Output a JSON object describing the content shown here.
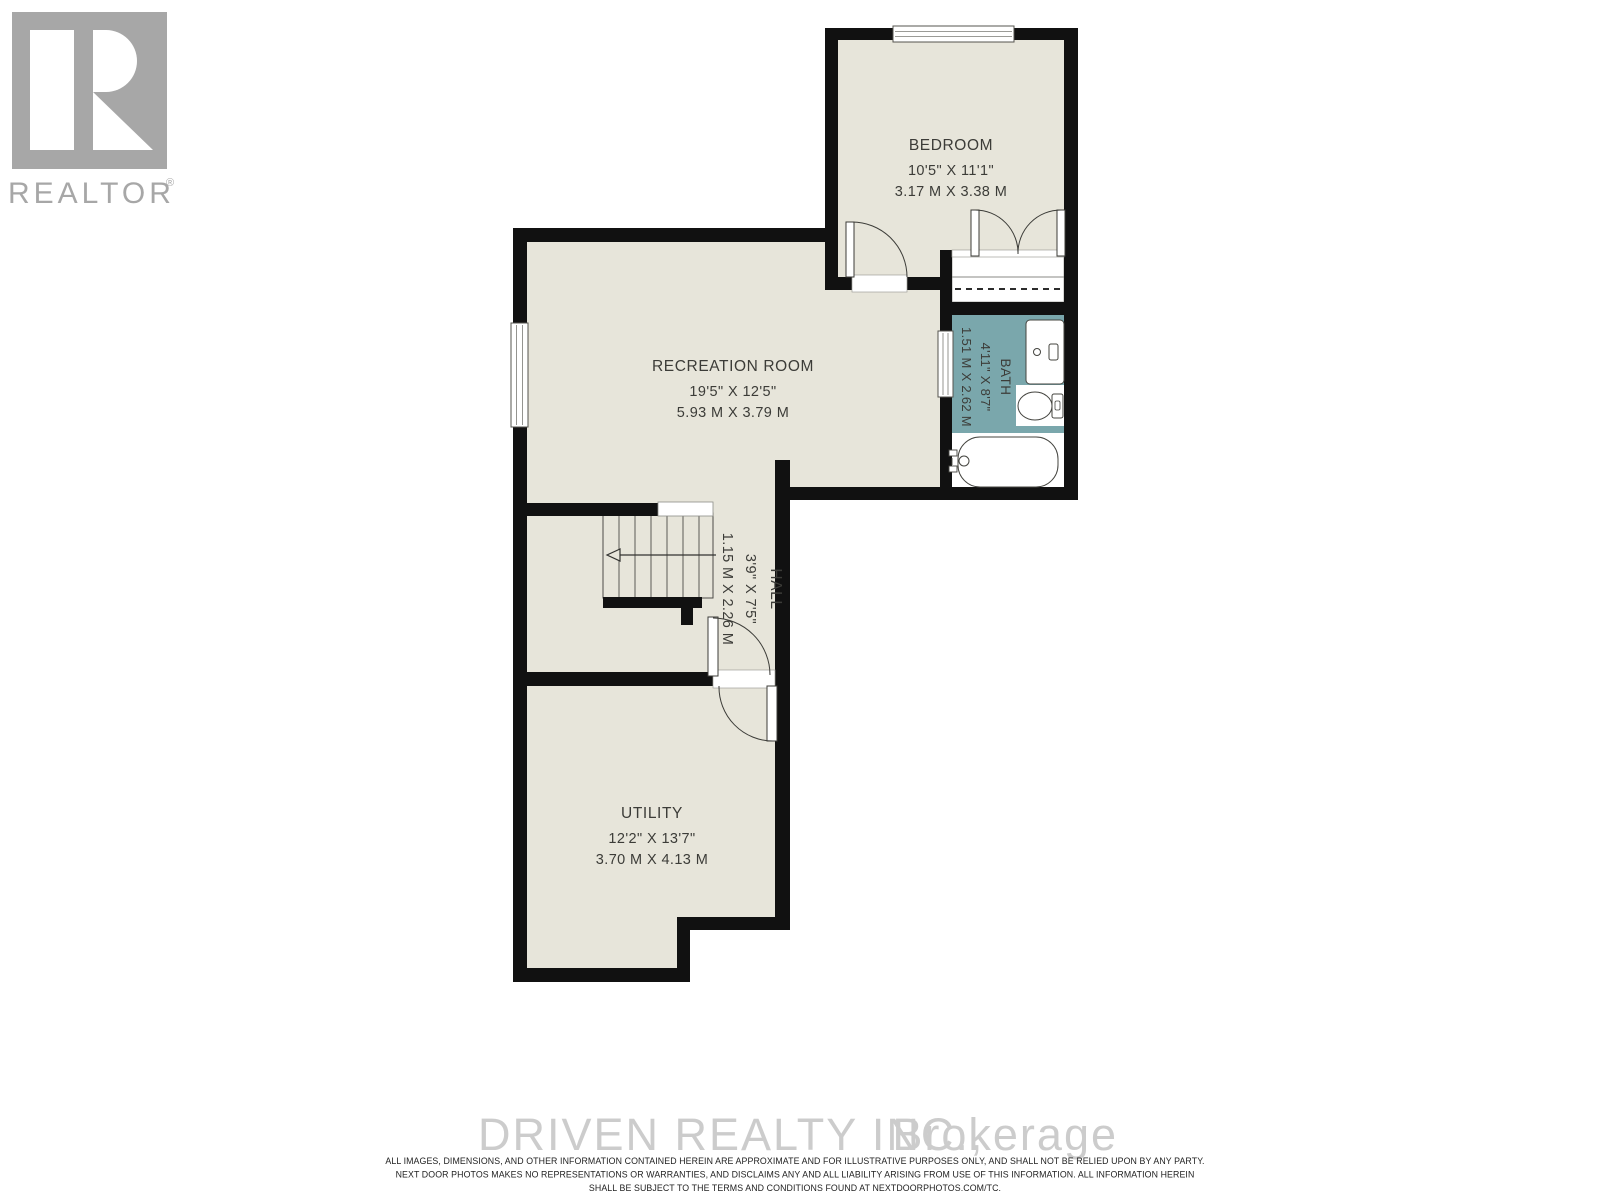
{
  "branding": {
    "logo_letter": "R",
    "logo_text": "REALTOR",
    "logo_registered": "®"
  },
  "rooms": {
    "bedroom": {
      "name": "BEDROOM",
      "imperial": "10'5\" X 11'1\"",
      "metric": "3.17 M X 3.38 M"
    },
    "recreation": {
      "name": "RECREATION ROOM",
      "imperial": "19'5\" X 12'5\"",
      "metric": "5.93 M X 3.79 M"
    },
    "bath": {
      "name": "BATH",
      "imperial": "4'11\" X 8'7\"",
      "metric": "1.51 M X 2.62 M"
    },
    "hall": {
      "name": "HALL",
      "imperial": "3'9\" X 7'5\"",
      "metric": "1.15 M X 2.26 M"
    },
    "utility": {
      "name": "UTILITY",
      "imperial": "12'2\" X 13'7\"",
      "metric": "3.70 M X 4.13 M"
    }
  },
  "watermark": {
    "name": "DRIVEN REALTY INC.,",
    "suffix": "Brokerage"
  },
  "disclaimer": {
    "line1": "ALL IMAGES, DIMENSIONS, AND OTHER INFORMATION CONTAINED HEREIN ARE APPROXIMATE AND FOR ILLUSTRATIVE PURPOSES ONLY, AND SHALL NOT BE RELIED UPON BY ANY PARTY.",
    "line2": "NEXT DOOR PHOTOS MAKES NO REPRESENTATIONS OR WARRANTIES, AND DISCLAIMS ANY AND ALL LIABILITY ARISING FROM USE OF THIS INFORMATION. ALL INFORMATION HEREIN",
    "line3": "SHALL BE SUBJECT TO THE TERMS AND CONDITIONS FOUND AT NEXTDOORPHOTOS.COM/TC."
  },
  "colors": {
    "wall": "#111111",
    "floor": "#e7e5da",
    "bath_floor": "#7aa7ac",
    "fixture_white": "#ffffff",
    "label_text": "#3c3c38",
    "watermark_gray": "#cccccc",
    "logo_gray": "#a7a7a7"
  }
}
